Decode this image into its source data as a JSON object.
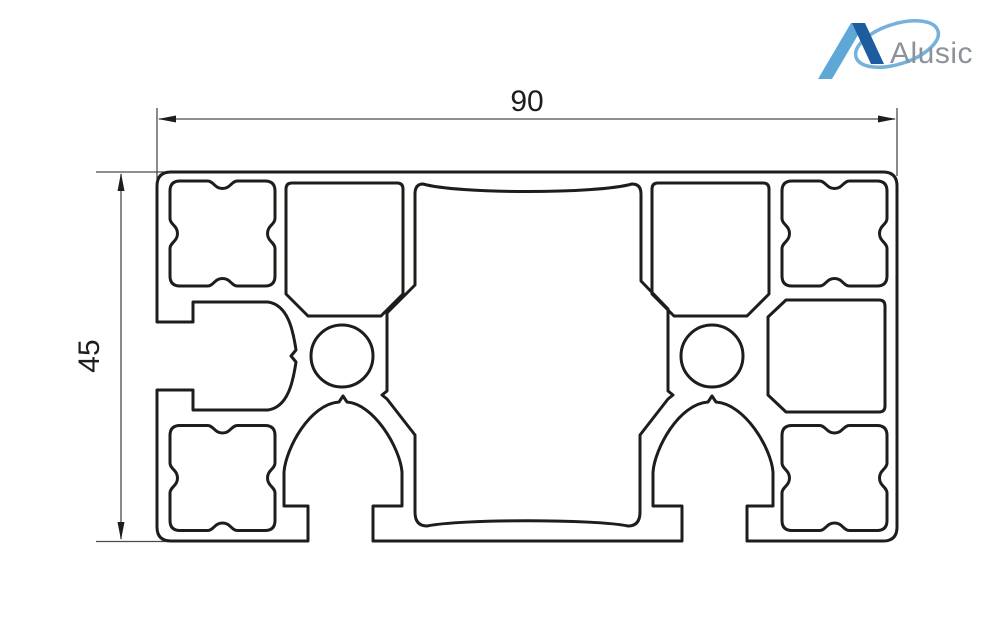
{
  "drawing": {
    "width_dimension": "90",
    "height_dimension": "45",
    "type": "aluminium-extrusion-profile-cross-section"
  },
  "logo": {
    "brand": "Alusic"
  },
  "colors": {
    "background": "#ffffff",
    "profile_line": "#1d1d1b",
    "dimension_line": "#4a4a49",
    "dimension_text": "#1d1d1b",
    "logo_light_blue": "#5ea8d8",
    "logo_dark_blue": "#1d5c9e",
    "logo_swoosh": "#74b2dc",
    "logo_text": "#8c9299"
  }
}
